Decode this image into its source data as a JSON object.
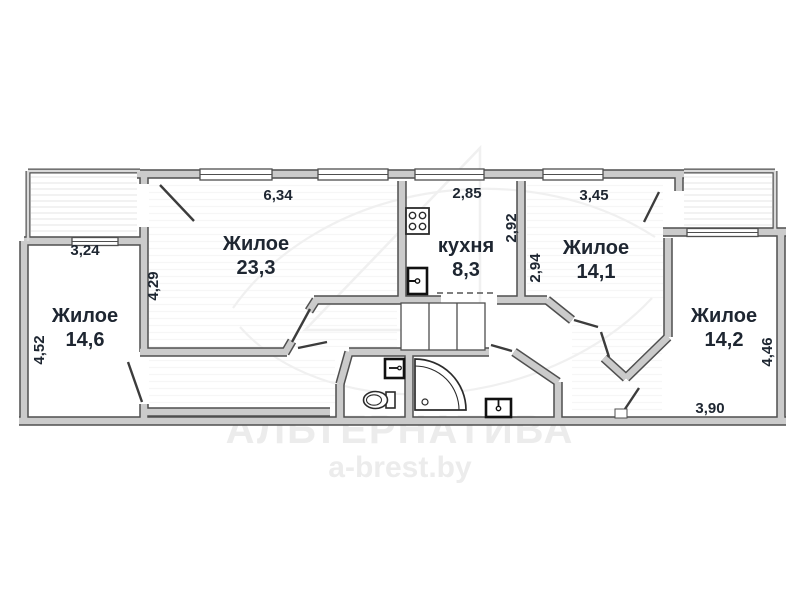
{
  "plan_title": "apartment-floor-plan",
  "rooms": [
    {
      "label": "Жилое",
      "area": "23,3"
    },
    {
      "label": "кухня",
      "area": "8,3"
    },
    {
      "label": "Жилое",
      "area": "14,1"
    },
    {
      "label": "Жилое",
      "area": "14,6"
    },
    {
      "label": "Жилое",
      "area": "14,2"
    }
  ],
  "dimensions": {
    "room233_width": "6,34",
    "kitchen_width": "2,85",
    "room141_width": "3,45",
    "room146_width": "3,24",
    "room233_depth": "4,29",
    "kitchen_depth": "2,92",
    "room141_depth": "2,94",
    "room146_depth": "4,52",
    "room142_depth": "4,46",
    "room142_width": "3,90"
  },
  "watermark": {
    "brand": "АЛЬТЕРНАТИВА",
    "site": "a-brest.by"
  },
  "icons": {
    "stove": "stove-icon",
    "kitchen_sink": "sink-icon",
    "wc_toilet": "toilet-icon",
    "wc_basin": "washbasin-icon",
    "shower": "shower-tray-icon",
    "hall_basin": "washbasin-icon",
    "windows": "window-icon",
    "doors": "door-swing-icon"
  },
  "colors": {
    "wall_fill": "#cbcbcb",
    "wall_outline": "#4f4f4f",
    "label_text": "#1e2631",
    "watermark": "#ececec"
  }
}
